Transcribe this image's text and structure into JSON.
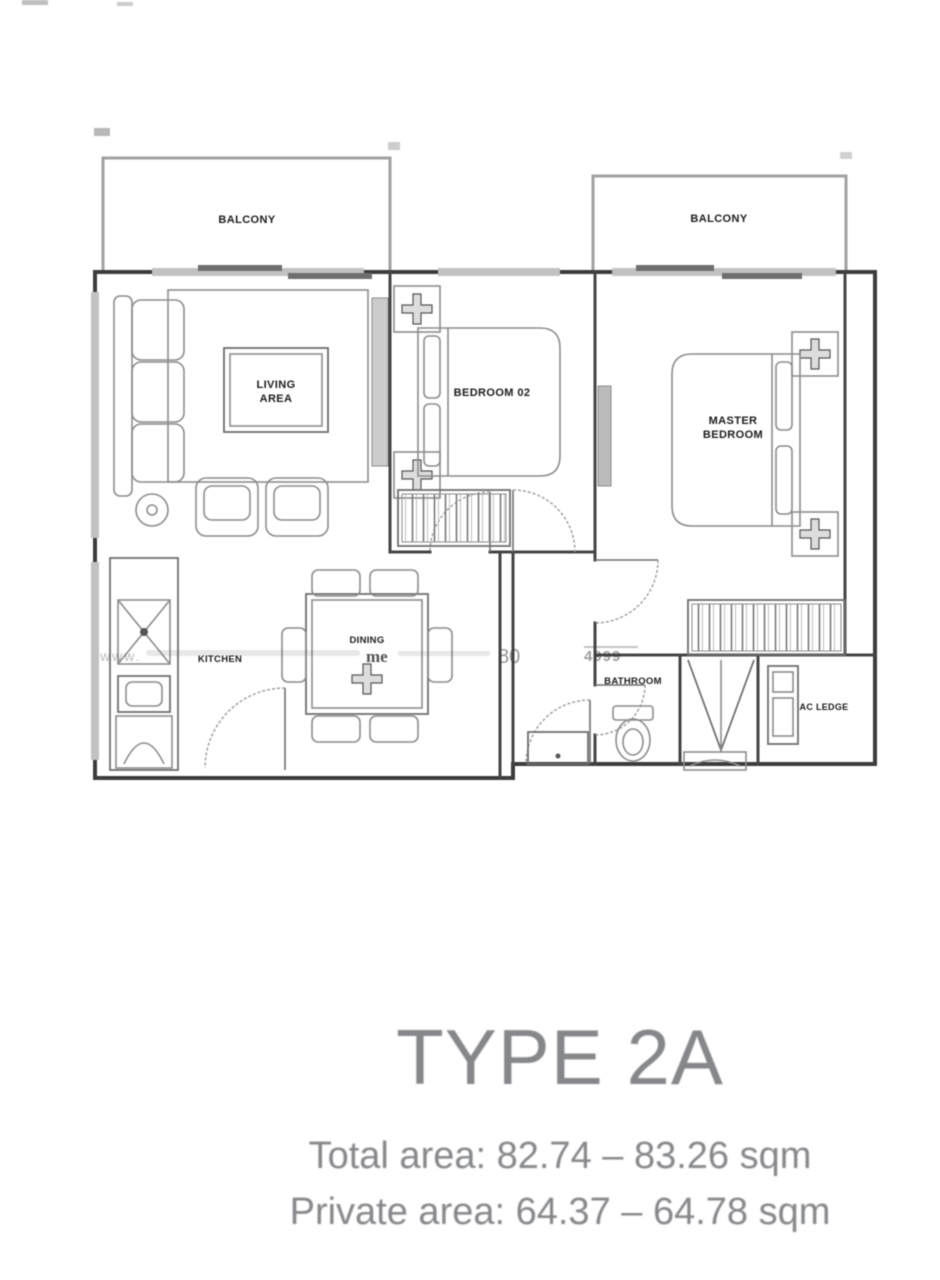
{
  "plan": {
    "balcony_left_label": "BALCONY",
    "balcony_right_label": "BALCONY",
    "living_line1": "LIVING",
    "living_line2": "AREA",
    "bedroom2_label": "BEDROOM 02",
    "master_line1": "MASTER",
    "master_line2": "BEDROOM",
    "kitchen_label": "KITCHEN",
    "dining_label": "DINING",
    "bathroom_label": "BATHROOM",
    "ac_ledge_label": "AC LEDGE",
    "watermark": {
      "prefix": "www.",
      "word": "me",
      "num1": "80",
      "num2": "4999"
    }
  },
  "caption": {
    "title": "TYPE 2A",
    "total_area": "Total area: 82.74 – 83.26 sqm",
    "private_area": "Private area: 64.37 – 64.78 sqm"
  },
  "colors": {
    "wall": "#3c3c3c",
    "furniture": "#8c8c8c",
    "caption_text": "#85878a"
  }
}
